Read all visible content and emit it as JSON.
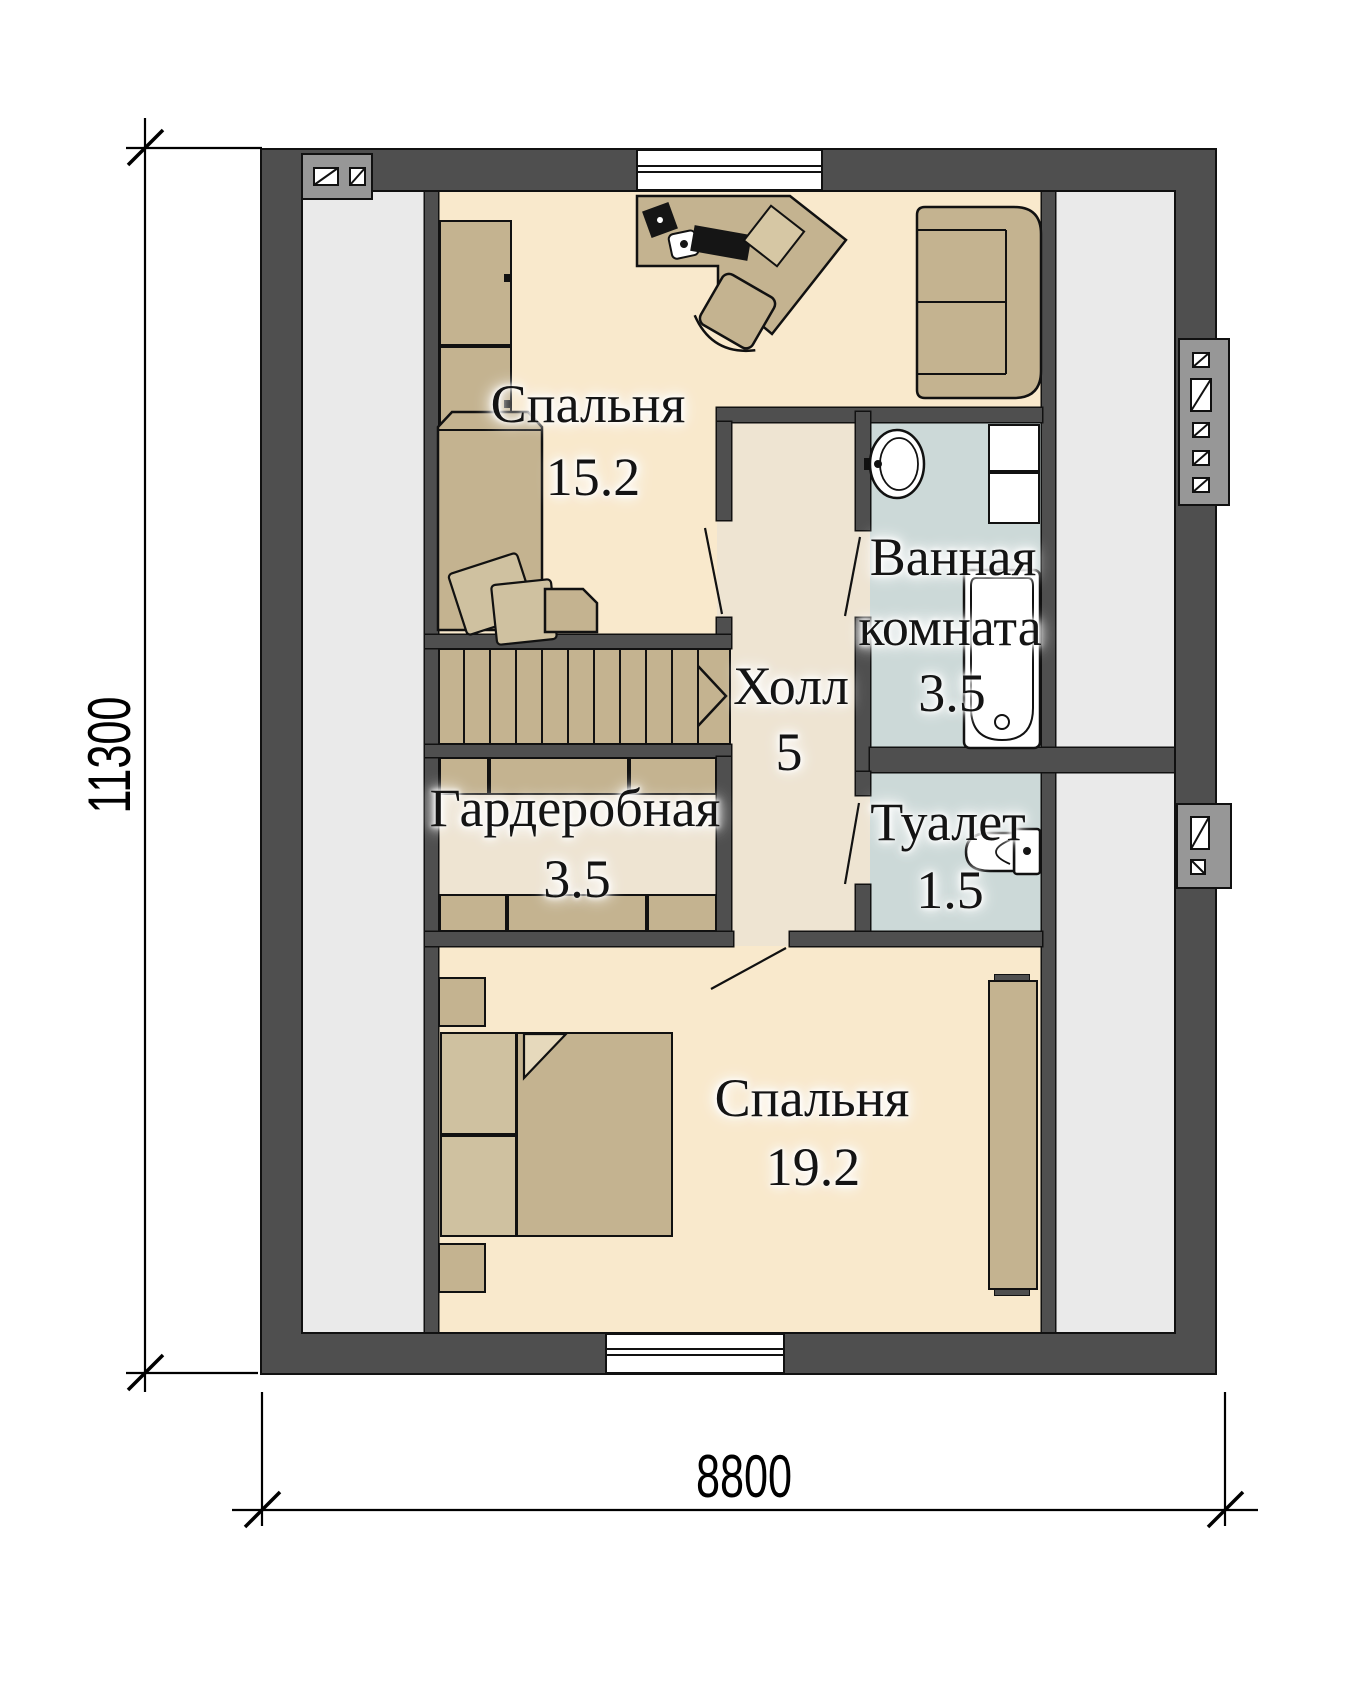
{
  "plan": {
    "type": "floor-plan",
    "rooms": [
      {
        "name": "Спальня",
        "area": "15.2"
      },
      {
        "name": "Ванная комната",
        "name_line1": "Ванная",
        "name_line2": "комната",
        "area": "3.5"
      },
      {
        "name": "Холл",
        "area": "5"
      },
      {
        "name": "Гардеробная",
        "area": "3.5"
      },
      {
        "name": "Туалет",
        "area": "1.5"
      },
      {
        "name": "Спальня",
        "area": "19.2"
      }
    ],
    "dimensions": {
      "width": "8800",
      "height": "11300"
    },
    "colors": {
      "wall": "#4f4f4f",
      "floor_bedroom": "#f9e9cc",
      "floor_hall": "#eee4d2",
      "floor_wet": "#ccd9d8",
      "floor_attic": "#eaeaea",
      "furniture": "#c4b390",
      "furniture_light": "#cfc1a0",
      "fixture": "#ffffff",
      "vent_block": "#979797",
      "line": "#111111"
    }
  }
}
